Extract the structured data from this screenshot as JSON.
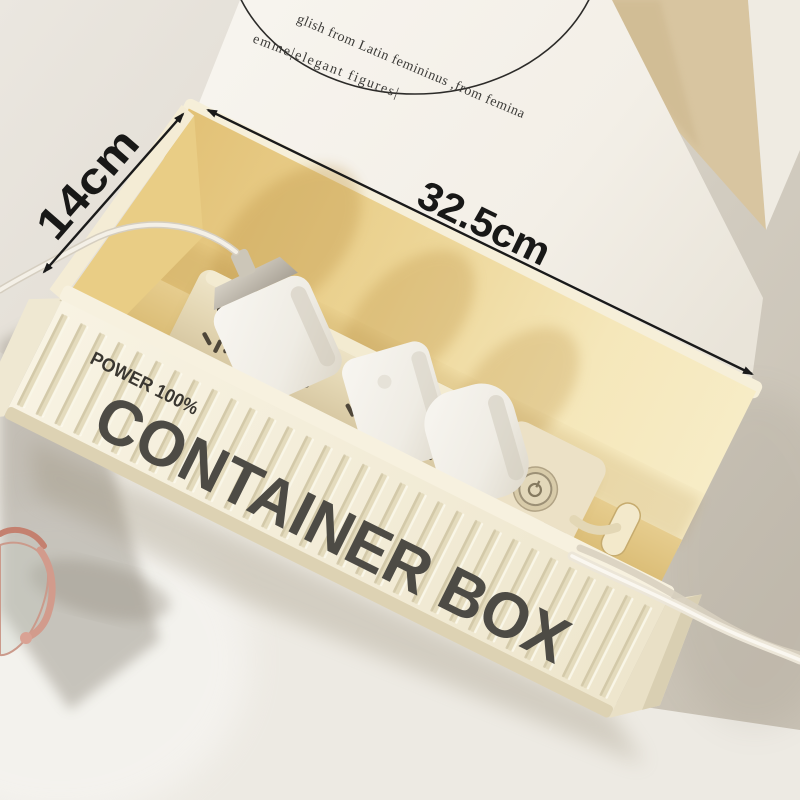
{
  "annotations": {
    "height_label": "14cm",
    "width_label": "32.5cm",
    "line_color": "#1a1a1a"
  },
  "backdrop": {
    "card_line1": "glish from Latin femininus ,from femina",
    "card_line2": "emme|elegant figures|",
    "card_color": "#f5f2eb",
    "beige_panel_color": "#d8c5a0",
    "wall_color": "#d6d0c6"
  },
  "box": {
    "rim_text": "POWER 100%",
    "side_text": "CONTAINER BOX",
    "body_color": "#f4eedb",
    "interior_color": "#ead092",
    "text_color": "#4d4b45"
  },
  "power_strip": {
    "body_color": "#e8ddbf",
    "button_icon": "power-icon",
    "socket_count": 4
  },
  "accessories": {
    "charger_count": 3,
    "cable_color": "#f1ede3",
    "eyeglasses_color": "#cb9a8b"
  }
}
